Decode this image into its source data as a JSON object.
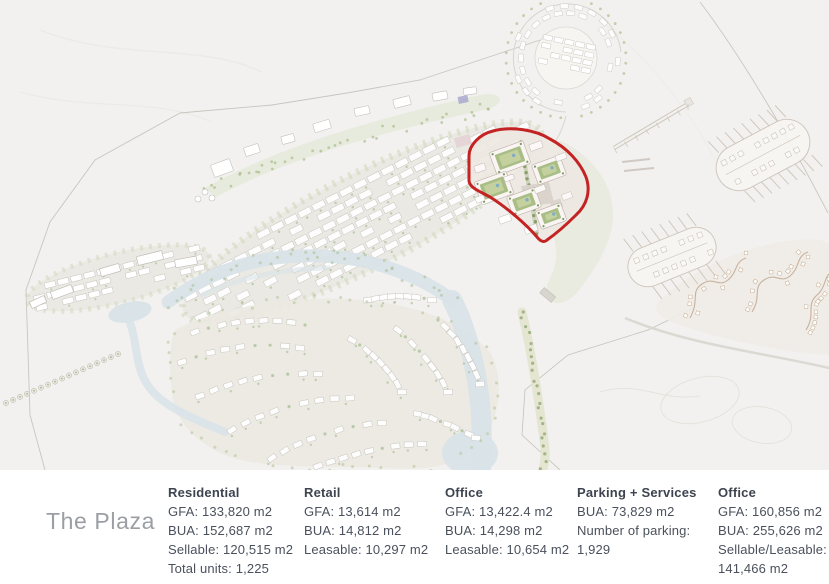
{
  "map": {
    "name": "resort-masterplan",
    "highlight_color": "#c32322",
    "water_color": "#d9e3e8",
    "vegetation_color": "#aec29a",
    "courtyard_green": "#a3c184",
    "pool_blue": "#7fb1c9",
    "land_color": "#e9e8e1",
    "background_color": "#f2f1ef"
  },
  "panel": {
    "title": "The Plaza",
    "columns": [
      {
        "header": "Residential",
        "lines": [
          "GFA: 133,820 m2",
          "BUA: 152,687 m2",
          "Sellable: 120,515 m2",
          "Total units: 1,225"
        ]
      },
      {
        "header": "Retail",
        "lines": [
          "GFA: 13,614 m2",
          "BUA: 14,812 m2",
          "Leasable: 10,297 m2"
        ]
      },
      {
        "header": "Office",
        "lines": [
          "GFA: 13,422.4 m2",
          "BUA: 14,298 m2",
          "Leasable: 10,654 m2"
        ]
      },
      {
        "header": "Parking + Services",
        "lines": [
          "BUA: 73,829 m2",
          "Number of parking: 1,929"
        ]
      },
      {
        "header": "Office",
        "lines": [
          "GFA: 160,856 m2",
          "BUA: 255,626 m2",
          "Sellable/Leasable: 141,466 m2"
        ]
      }
    ]
  }
}
